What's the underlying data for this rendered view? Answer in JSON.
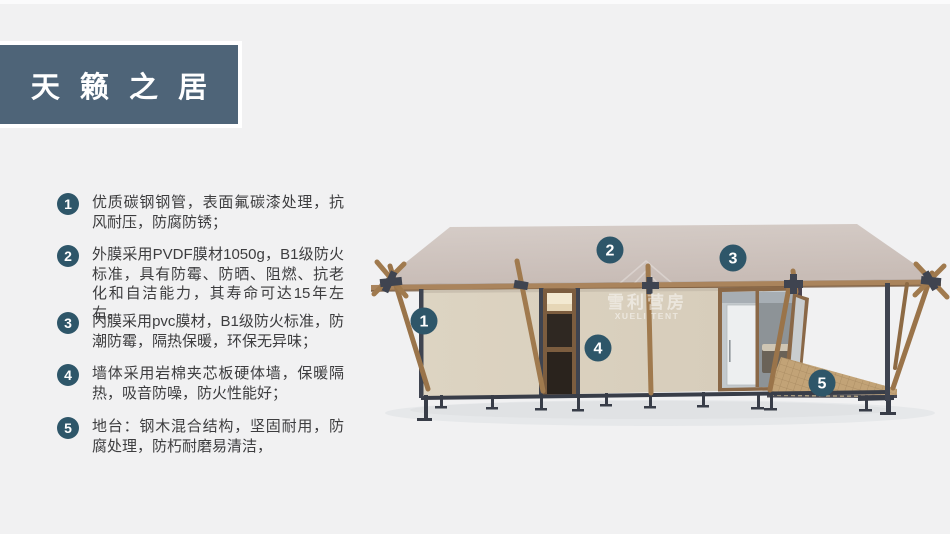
{
  "slide": {
    "title": "天 籁 之 居",
    "background_color": "#f1f1f2",
    "banner_color": "#4e6478",
    "accent_color": "#2e5669"
  },
  "features": [
    {
      "number": "1",
      "text": "优质碳钢钢管，表面氟碳漆处理，抗风耐压，防腐防锈；"
    },
    {
      "number": "2",
      "text": "外膜采用PVDF膜材1050g，B1级防火标准，具有防霉、防晒、阻燃、抗老化和自洁能力，其寿命可达15年左右。"
    },
    {
      "number": "3",
      "text": "内膜采用pvc膜材，B1级防火标准，防潮防霉，隔热保暖，环保无异味；"
    },
    {
      "number": "4",
      "text": "墙体采用岩棉夹芯板硬体墙，保暖隔热，吸音防噪，防火性能好；"
    },
    {
      "number": "5",
      "text": "地台：钢木混合结构，坚固耐用，防腐处理，防朽耐磨易清洁，"
    }
  ],
  "diagram": {
    "type": "annotated product render of a safari glamping tent cabin",
    "watermark": {
      "cn": "雪利营房",
      "en": "XUELI TENT"
    },
    "callouts": [
      {
        "number": "1"
      },
      {
        "number": "2"
      },
      {
        "number": "3"
      },
      {
        "number": "4"
      },
      {
        "number": "5"
      }
    ],
    "colors": {
      "roof": "#cdc2bd",
      "wall": "#dcd3c1",
      "wood": "#a07a4e",
      "steel": "#3a3f4b",
      "deck": "#c2a377",
      "glass": "#c3c9cd"
    }
  }
}
